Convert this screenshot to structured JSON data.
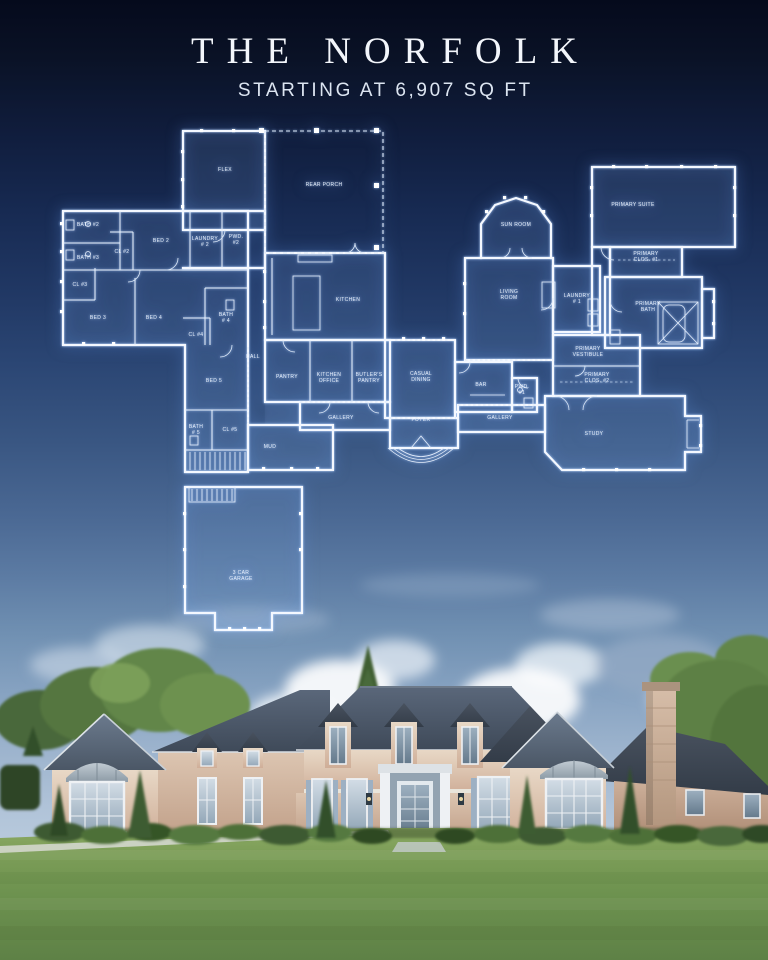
{
  "header": {
    "title": "THE NORFOLK",
    "subtitle": "STARTING AT 6,907 SQ FT"
  },
  "colors": {
    "background_top": "#050a1c",
    "background_mid": "#3a5784",
    "sky": "#b7c9dd",
    "blueprint_line": "#f4f8ff",
    "title_text": "#f3f6fb",
    "lawn": "#6b8f4e",
    "roof": "#4a5766",
    "brick": "#d7bfab"
  },
  "floor_plan": {
    "sheet_name": "first-floor-blueprint",
    "rooms": [
      {
        "id": "flex",
        "lines": [
          "FLEX"
        ],
        "x": 225,
        "y": 171
      },
      {
        "id": "rear-porch",
        "lines": [
          "REAR PORCH"
        ],
        "x": 324,
        "y": 186
      },
      {
        "id": "sun-room",
        "lines": [
          "SUN ROOM"
        ],
        "x": 516,
        "y": 226
      },
      {
        "id": "primary-suite",
        "lines": [
          "PRIMARY SUITE"
        ],
        "x": 633,
        "y": 206
      },
      {
        "id": "bath-2",
        "lines": [
          "BATH #2"
        ],
        "x": 88,
        "y": 226
      },
      {
        "id": "bed-2",
        "lines": [
          "BED 2"
        ],
        "x": 161,
        "y": 242
      },
      {
        "id": "laundry-2",
        "lines": [
          "LAUNDRY",
          "# 2"
        ],
        "x": 205,
        "y": 240
      },
      {
        "id": "pwd-2",
        "lines": [
          "PWD.",
          "#2"
        ],
        "x": 236,
        "y": 238
      },
      {
        "id": "cl-2",
        "lines": [
          "CL #2"
        ],
        "x": 122,
        "y": 253
      },
      {
        "id": "bath-3",
        "lines": [
          "BATH #3"
        ],
        "x": 88,
        "y": 259
      },
      {
        "id": "primary-clos-1",
        "lines": [
          "PRIMARY",
          "CLOS. #1"
        ],
        "x": 646,
        "y": 255
      },
      {
        "id": "cl-3",
        "lines": [
          "CL #3"
        ],
        "x": 80,
        "y": 286
      },
      {
        "id": "kitchen",
        "lines": [
          "KITCHEN"
        ],
        "x": 348,
        "y": 301
      },
      {
        "id": "living-room",
        "lines": [
          "LIVING",
          "ROOM"
        ],
        "x": 509,
        "y": 293
      },
      {
        "id": "laundry-1",
        "lines": [
          "LAUNDRY",
          "# 1"
        ],
        "x": 577,
        "y": 297
      },
      {
        "id": "primary-bath",
        "lines": [
          "PRIMARY",
          "BATH"
        ],
        "x": 648,
        "y": 305
      },
      {
        "id": "bed-3",
        "lines": [
          "BED 3"
        ],
        "x": 98,
        "y": 319
      },
      {
        "id": "bed-4",
        "lines": [
          "BED 4"
        ],
        "x": 154,
        "y": 319
      },
      {
        "id": "bath-4",
        "lines": [
          "BATH",
          "# 4"
        ],
        "x": 226,
        "y": 316
      },
      {
        "id": "cl-4",
        "lines": [
          "CL #4"
        ],
        "x": 196,
        "y": 336
      },
      {
        "id": "hall",
        "lines": [
          "HALL"
        ],
        "x": 253,
        "y": 358
      },
      {
        "id": "primary-vestibule",
        "lines": [
          "PRIMARY",
          "VESTIBULE"
        ],
        "x": 588,
        "y": 350
      },
      {
        "id": "bed-5",
        "lines": [
          "BED 5"
        ],
        "x": 214,
        "y": 382
      },
      {
        "id": "pantry",
        "lines": [
          "PANTRY"
        ],
        "x": 287,
        "y": 378
      },
      {
        "id": "kitchen-office",
        "lines": [
          "KITCHEN",
          "OFFICE"
        ],
        "x": 329,
        "y": 376
      },
      {
        "id": "butlers-pantry",
        "lines": [
          "BUTLER'S",
          "PANTRY"
        ],
        "x": 369,
        "y": 376
      },
      {
        "id": "casual-dining",
        "lines": [
          "CASUAL",
          "DINING"
        ],
        "x": 421,
        "y": 375
      },
      {
        "id": "bar",
        "lines": [
          "BAR"
        ],
        "x": 481,
        "y": 386
      },
      {
        "id": "pwd-1",
        "lines": [
          "PWD.",
          "#1"
        ],
        "x": 522,
        "y": 388
      },
      {
        "id": "primary-clos-2",
        "lines": [
          "PRIMARY",
          "CLOS. #2"
        ],
        "x": 597,
        "y": 376
      },
      {
        "id": "gallery-west",
        "lines": [
          "GALLERY"
        ],
        "x": 341,
        "y": 419
      },
      {
        "id": "foyer",
        "lines": [
          "FOYER"
        ],
        "x": 421,
        "y": 421
      },
      {
        "id": "gallery-east",
        "lines": [
          "GALLERY"
        ],
        "x": 500,
        "y": 419
      },
      {
        "id": "study",
        "lines": [
          "STUDY"
        ],
        "x": 594,
        "y": 435
      },
      {
        "id": "bath-5",
        "lines": [
          "BATH",
          "# 5"
        ],
        "x": 196,
        "y": 428
      },
      {
        "id": "cl-5",
        "lines": [
          "CL #5"
        ],
        "x": 230,
        "y": 431
      },
      {
        "id": "mud",
        "lines": [
          "MUD"
        ],
        "x": 270,
        "y": 448
      },
      {
        "id": "garage",
        "lines": [
          "3 CAR",
          "GARAGE"
        ],
        "x": 241,
        "y": 574
      }
    ]
  }
}
